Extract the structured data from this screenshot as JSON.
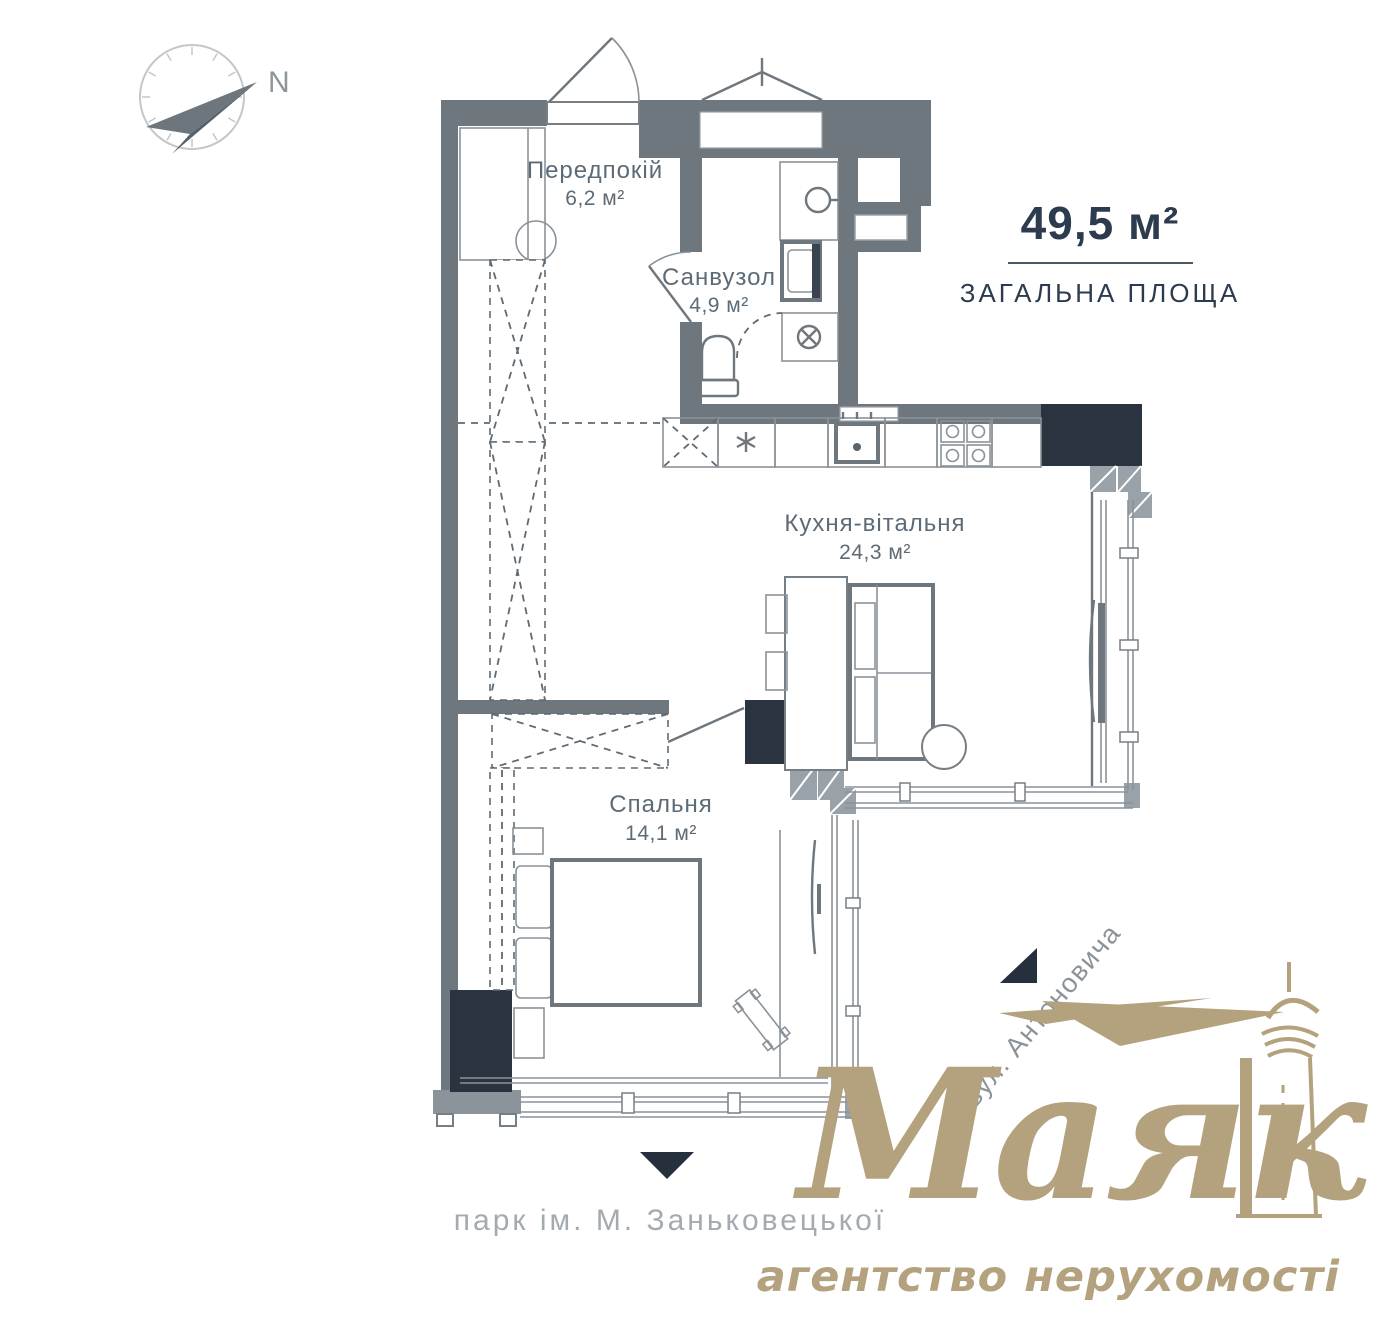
{
  "compass": {
    "label": "N"
  },
  "summary": {
    "value": "49,5 м²",
    "label": "ЗАГАЛЬНА ПЛОЩА"
  },
  "rooms": [
    {
      "name": "Передпокій",
      "area": "6,2 м²"
    },
    {
      "name": "Санвузол",
      "area": "4,9 м²"
    },
    {
      "name": "Кухня-вітальня",
      "area": "24,3 м²"
    },
    {
      "name": "Спальня",
      "area": "14,1 м²"
    }
  ],
  "labels": {
    "street": "вул. Антоновича",
    "park": "парк ім. М. Заньковецької"
  },
  "logo": {
    "wordmark": "Маяк",
    "tagline": "агентство нерухомості"
  },
  "colors": {
    "wall": "#6e777d",
    "column": "#2a3440",
    "gold": "#b3a27d",
    "navy_text": "#2c3b4e",
    "gray_text": "#9aa2a8"
  }
}
